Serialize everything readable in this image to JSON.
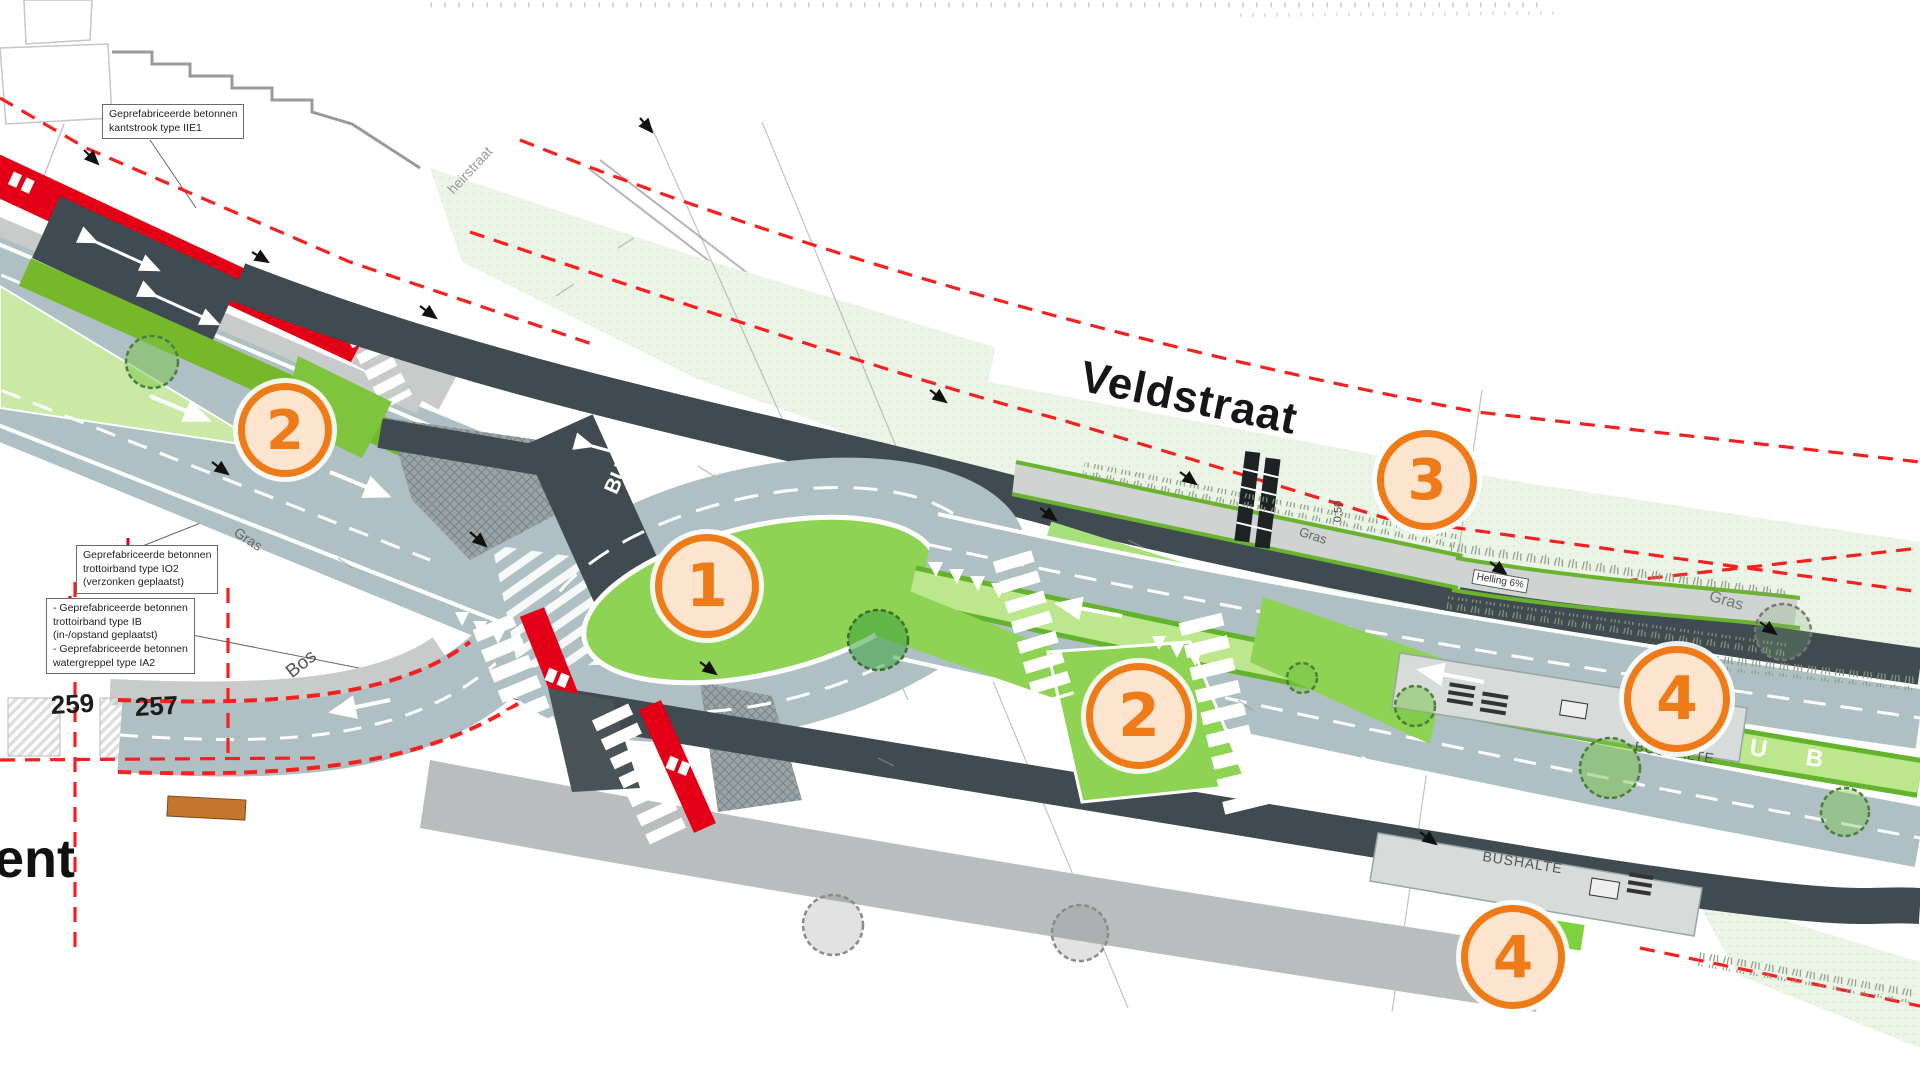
{
  "street_labels": {
    "veldstraat": "Veldstraat",
    "ent_partial": "ent",
    "heirstraat": "heirstraat"
  },
  "land_labels": {
    "bos": "Bos",
    "gras_left": "Gras",
    "gras_mid": "Gras",
    "gras_right": "Gras",
    "level": "0.50",
    "helling": "Helling 6%"
  },
  "house_numbers": {
    "left": "259",
    "right": "257"
  },
  "bus": {
    "lane_marking": "BUS",
    "stop_label_top": "BUSHALTE",
    "stop_label_bottom": "BUSHALTE",
    "lane_letters_top": [
      "S",
      "U",
      "B"
    ],
    "lane_letters_bottom": [
      "S",
      "U",
      "B"
    ]
  },
  "annotation_boxes": {
    "kantstrook": {
      "line1": "Geprefabriceerde betonnen",
      "line2": "kantstrook type IIE1"
    },
    "trottoirband_io2": {
      "line1": "Geprefabriceerde betonnen",
      "line2": "trottoirband type IO2",
      "line3": "(verzonken geplaatst)"
    },
    "trottoirband_ib": {
      "line1": "- Geprefabriceerde betonnen",
      "line2": "trottoirband type IB",
      "line3": "(in-/opstand geplaatst)",
      "line4": "- Geprefabriceerde betonnen",
      "line5": "watergreppel type IA2"
    }
  },
  "markers": [
    {
      "label": "2"
    },
    {
      "label": "1"
    },
    {
      "label": "2"
    },
    {
      "label": "3"
    },
    {
      "label": "4"
    },
    {
      "label": "4"
    }
  ],
  "colors": {
    "marker_orange": "#ee7b17",
    "marker_fill": "#fce4cf",
    "road_gray": "#aec0c3",
    "asphalt_dark": "#3f4b50",
    "cycle_red": "#e30016",
    "cycle_green": "#76b82a",
    "island_green": "#8ed353",
    "median_green": "#bce78c",
    "verge_mint": "#ecf4e7",
    "boundary_red_dash": "#f52020",
    "sidewalk_gray": "#b9bdbd"
  }
}
